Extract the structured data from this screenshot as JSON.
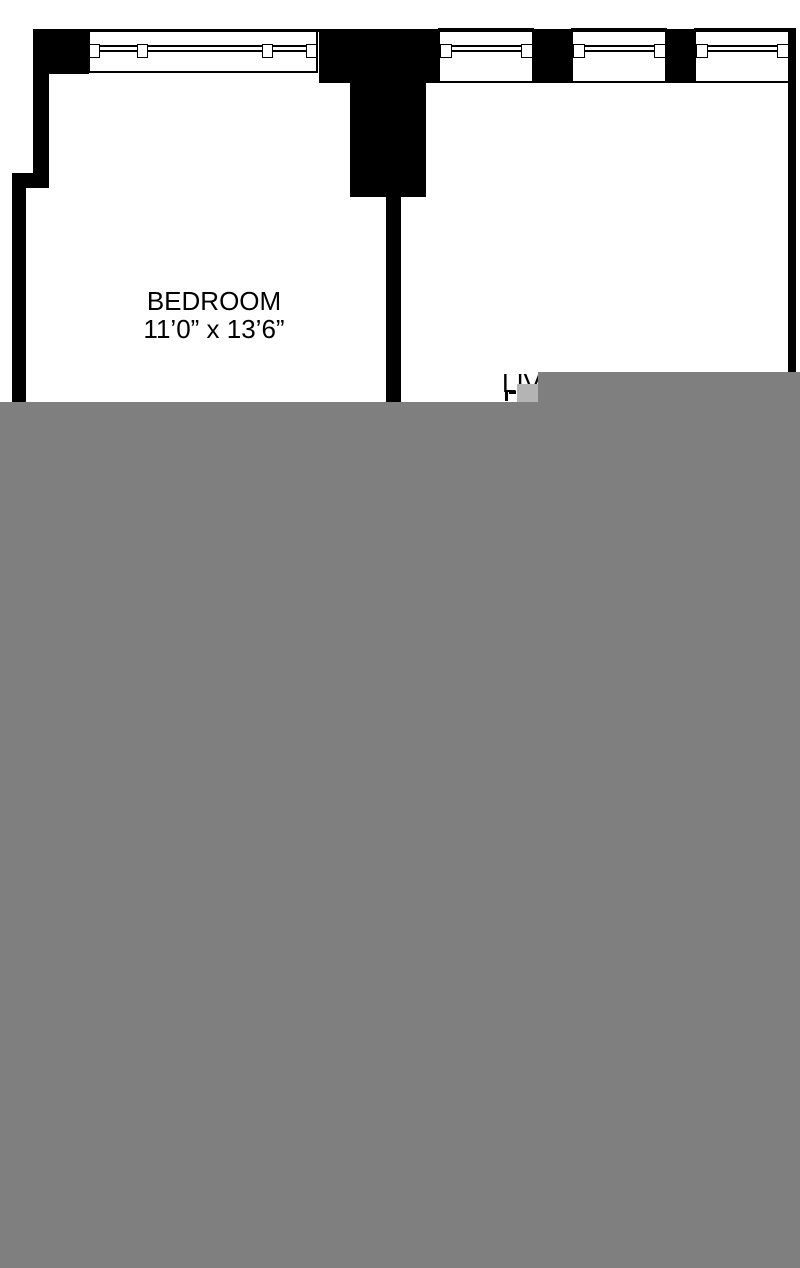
{
  "floor_plan": {
    "rooms": {
      "bedroom": {
        "label": "BEDROOM",
        "dimensions": "11’0” x 13’6”"
      },
      "living_room": {
        "label": "LIVING ROOM",
        "visible_fragment": "LIV"
      }
    },
    "features": {
      "bedroom_windows_count": 1,
      "living_room_windows_count": 3
    },
    "colors": {
      "walls": "#000000",
      "floor_background": "#ffffff",
      "unloaded_overlay": "#7f7f7f",
      "unloaded_overlay_light": "#b4b4b4",
      "text": "#000000"
    }
  }
}
